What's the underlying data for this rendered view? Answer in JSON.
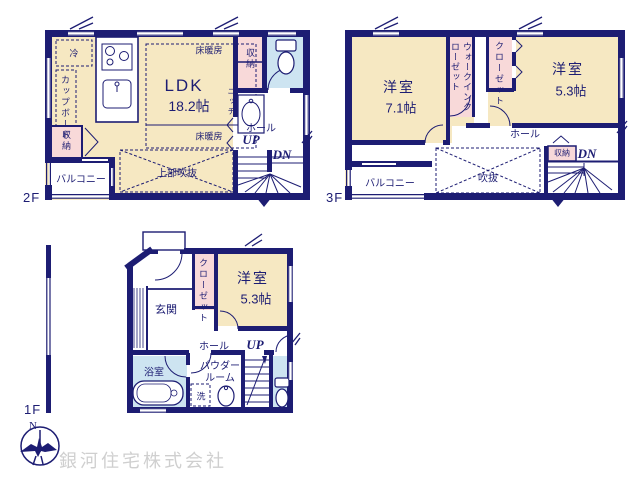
{
  "colors": {
    "wall": "#1d1d73",
    "room_fill": "#f6e8c2",
    "closet_fill": "#f8d9d9",
    "wet_area_fill": "#cde4f1",
    "company_text": "#cfcfcf"
  },
  "floor2": {
    "floor_label": "2F",
    "ldk": "LDK",
    "ldk_size": "18.2帖",
    "fridge": "冷",
    "cupboard": "カップボード",
    "storage_left": "収納",
    "storage_right": "収納",
    "floor_heating_top": "床暖房",
    "floor_heating_bottom": "床暖房",
    "niche": "ニッチ",
    "hall": "ホール",
    "up": "UP",
    "down": "DN",
    "void_above": "上部吹抜",
    "balcony": "バルコニー"
  },
  "floor3": {
    "floor_label": "3F",
    "bedroom_left": "洋室",
    "bedroom_left_size": "7.1帖",
    "bedroom_right": "洋室",
    "bedroom_right_size": "5.3帖",
    "walk_in_closet": "ウォークインクローゼット",
    "closet": "クローゼット",
    "hall": "ホール",
    "storage": "収納",
    "down": "DN",
    "void": "吹抜",
    "balcony": "バルコニー"
  },
  "floor1": {
    "floor_label": "1F",
    "bedroom": "洋室",
    "bedroom_size": "5.3帖",
    "closet": "クローゼット",
    "entrance": "玄関",
    "hall": "ホール",
    "up": "UP",
    "bath": "浴室",
    "powder_room": "パウダールーム",
    "laundry": "洗"
  },
  "footer": {
    "compass_north": "N",
    "company": "銀河住宅株式会社"
  }
}
